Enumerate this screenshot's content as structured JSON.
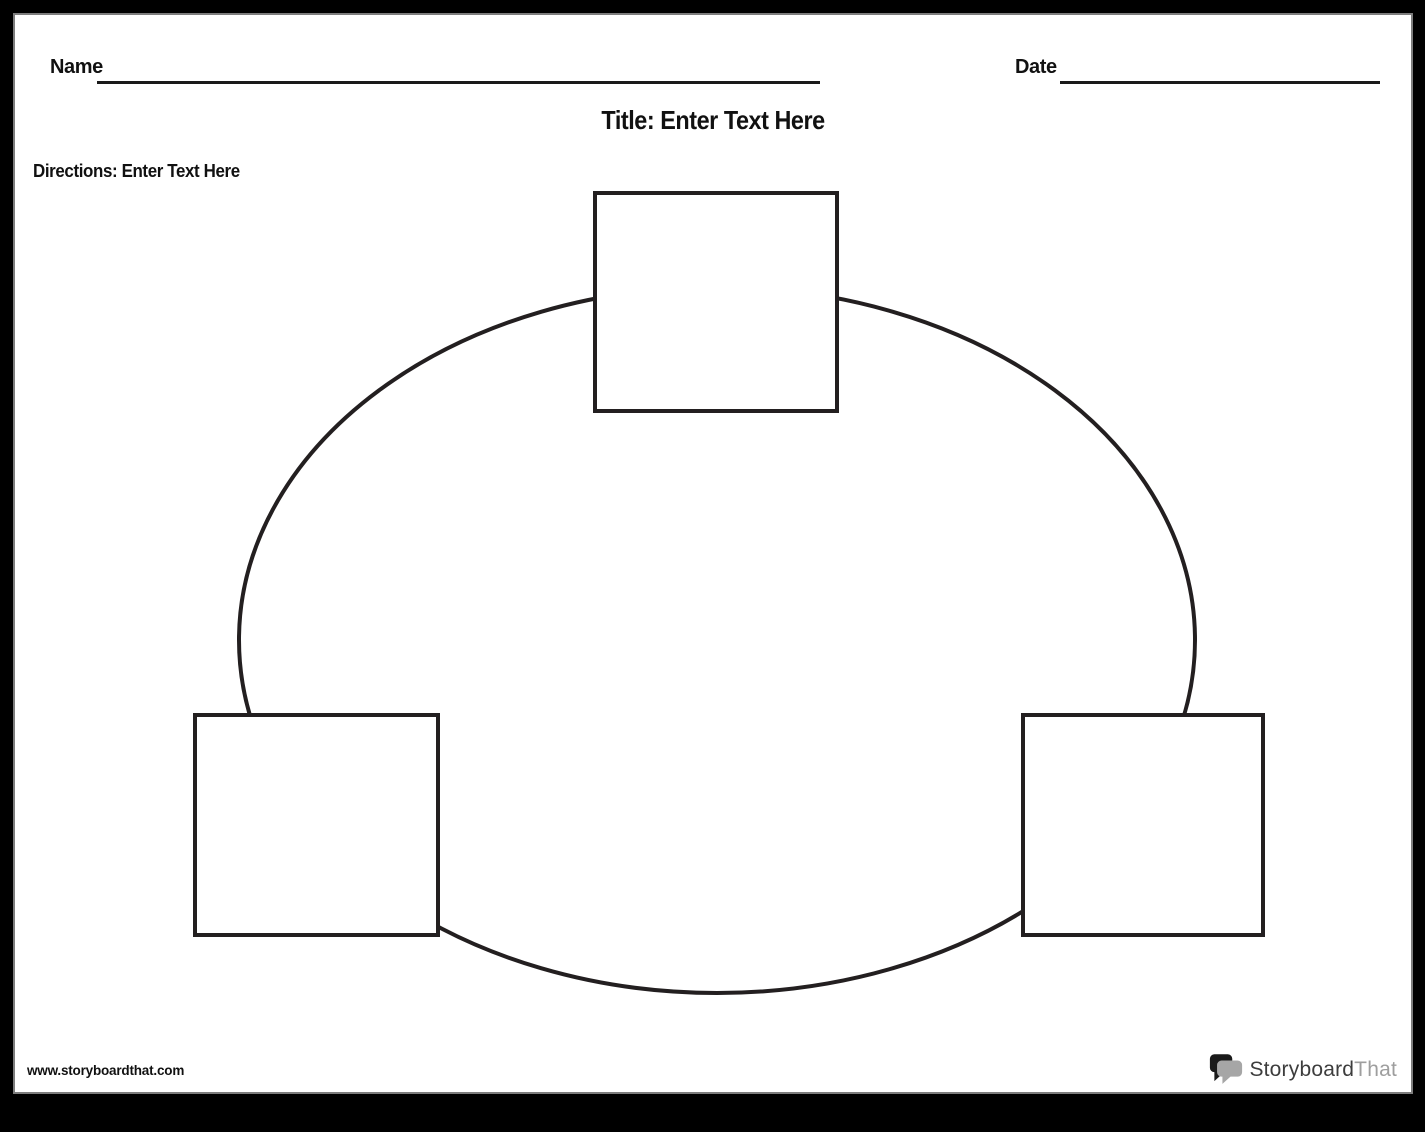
{
  "page": {
    "background_color": "#000000",
    "paper_color": "#ffffff",
    "paper_edge_color": "#7d7d7d",
    "line_color": "#231f20"
  },
  "header": {
    "name_label": "Name",
    "date_label": "Date",
    "title": "Title: Enter Text Here",
    "directions": "Directions: Enter Text Here"
  },
  "diagram": {
    "type": "circle-chart-template",
    "boxes": [
      {
        "position": "top",
        "text": ""
      },
      {
        "position": "bottom-left",
        "text": ""
      },
      {
        "position": "bottom-right",
        "text": ""
      }
    ]
  },
  "footer": {
    "website": "www.storyboardthat.com",
    "logo": {
      "icon": "speech-bubbles-icon",
      "brand_primary": "Storyboard",
      "brand_secondary": "That",
      "primary_color": "#3d3d3d",
      "secondary_color": "#9e9e9e",
      "bubble_back_color": "#1a1a1a",
      "bubble_front_color": "#a6a6a6"
    }
  }
}
